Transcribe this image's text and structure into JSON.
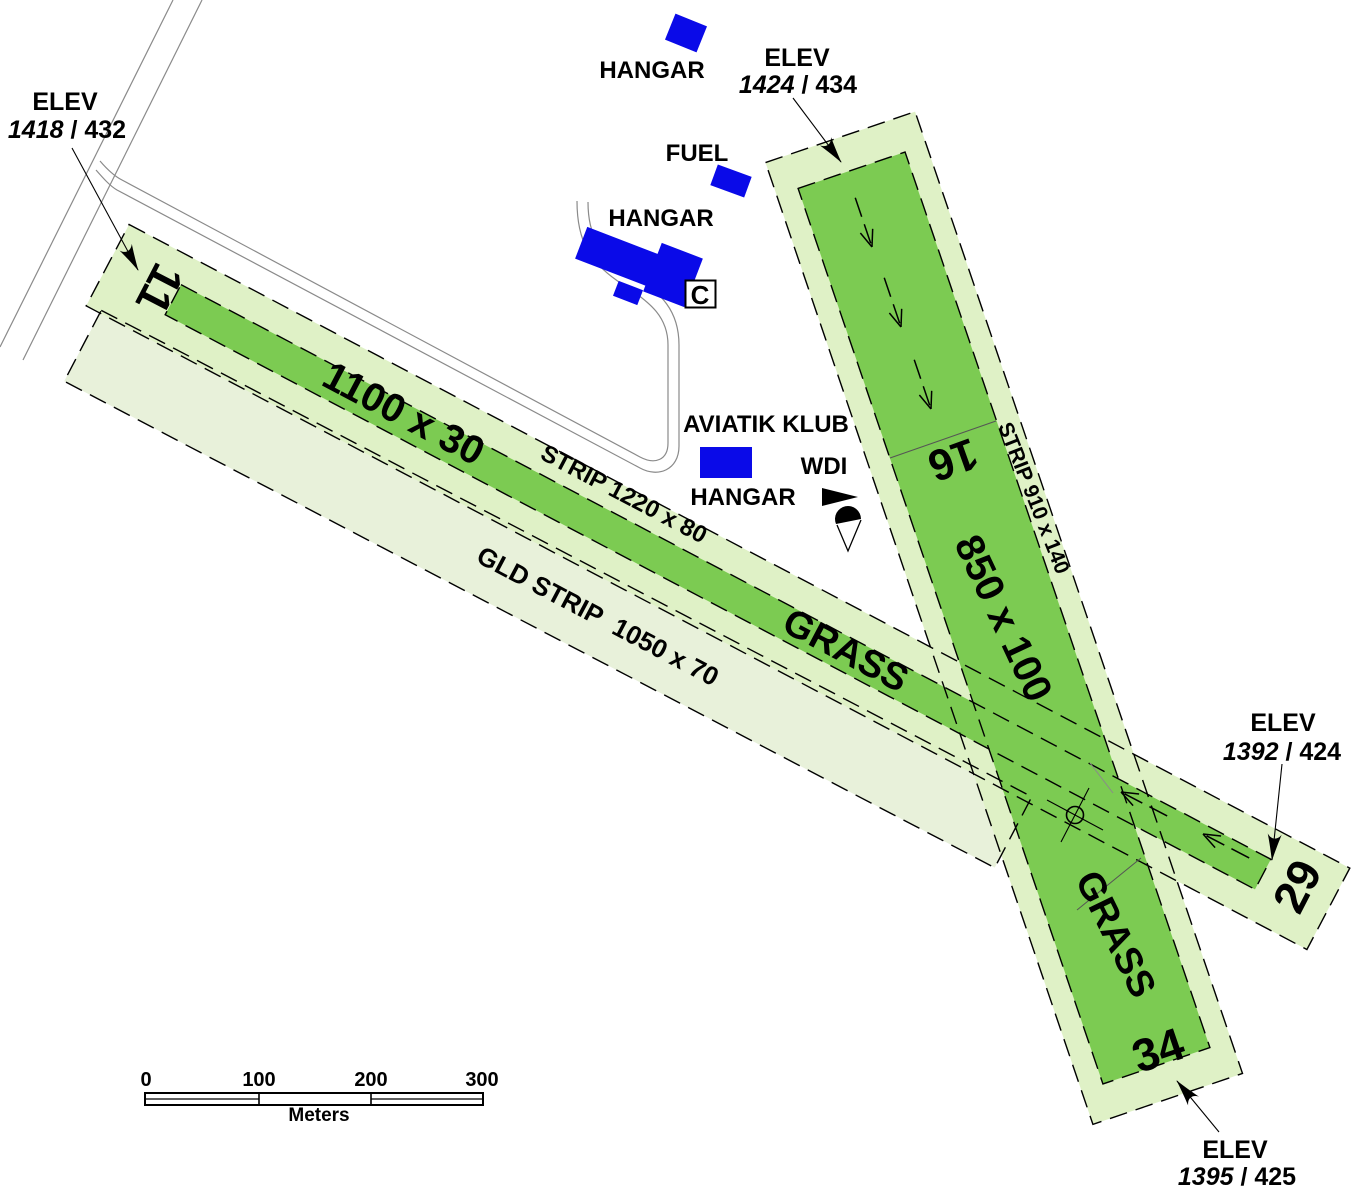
{
  "colors": {
    "runway_green": "#7CCB52",
    "strip_green": "#DFF1C6",
    "glider_strip_green": "#E8F1DA",
    "building_blue": "#0A0AE8"
  },
  "labels": {
    "hangar_north": "HANGAR",
    "fuel": "FUEL",
    "hangar_c": "HANGAR",
    "hangar_c_code": "C",
    "aviatik_klub_line1": "AVIATIK KLUB",
    "aviatik_klub_line2": "HANGAR",
    "wdi": "WDI",
    "runway_main_dimensions": "1100 x 30",
    "runway_main_strip": "STRIP 1220 x 80",
    "glider_strip": "GLD STRIP  1050 x 70",
    "runway_main_surface": "GRASS",
    "runway_cross_dimensions": "850 x 100",
    "runway_cross_strip": "STRIP 910 x 140",
    "runway_cross_surface": "GRASS",
    "rwy_11": "11",
    "rwy_29": "29",
    "rwy_16": "16",
    "rwy_34": "34"
  },
  "elevations": {
    "northwest": {
      "label": "ELEV",
      "value_ft": "1418",
      "separator": " / ",
      "value_m": "432"
    },
    "northeast": {
      "label": "ELEV",
      "value_ft": "1424",
      "separator": " / ",
      "value_m": "434"
    },
    "east": {
      "label": "ELEV",
      "value_ft": "1392",
      "separator": " / ",
      "value_m": "424"
    },
    "south": {
      "label": "ELEV",
      "value_ft": "1395",
      "separator": " / ",
      "value_m": "425"
    }
  },
  "scale_bar": {
    "ticks": [
      "0",
      "100",
      "200",
      "300"
    ],
    "unit": "Meters"
  }
}
